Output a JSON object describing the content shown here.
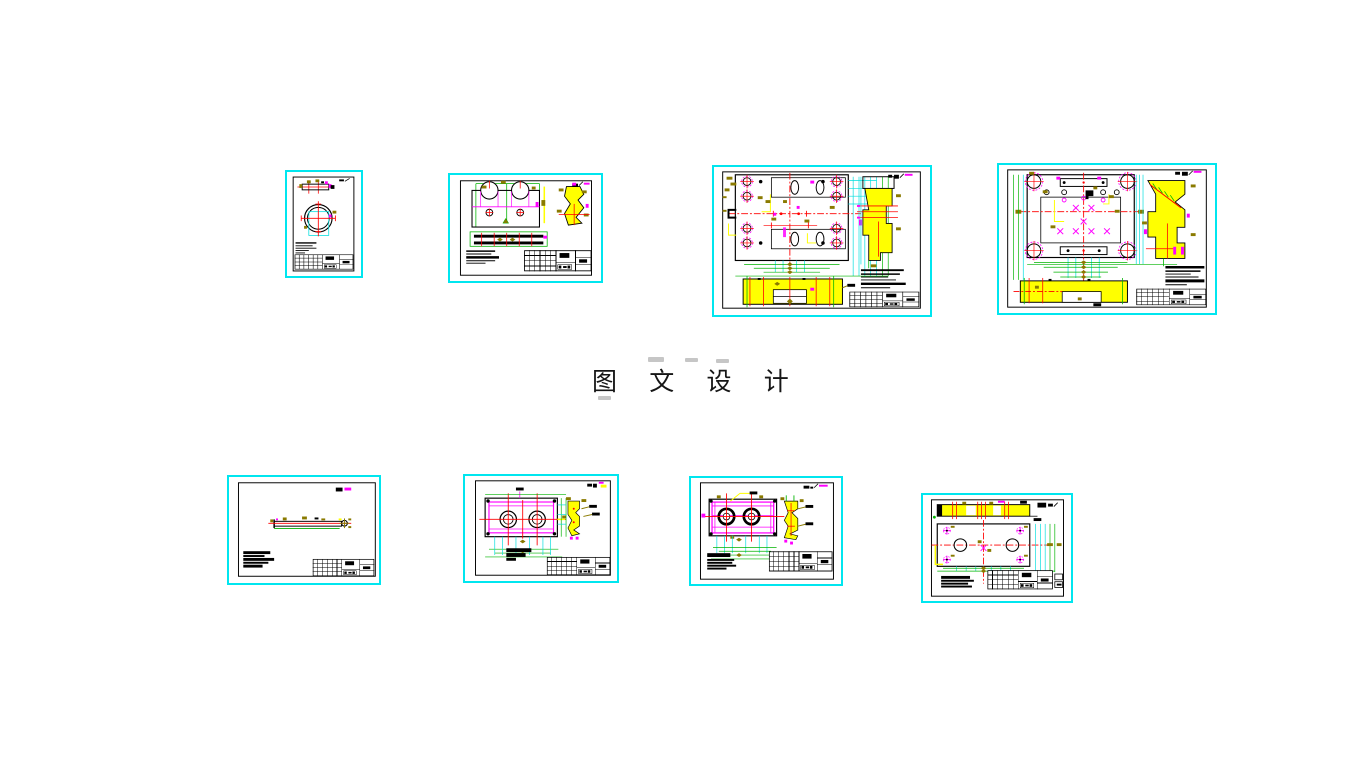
{
  "page": {
    "title": "图 文 设 计"
  },
  "palette": {
    "background": "#ffffff",
    "sheet_frame_cyan": "#00e6ef",
    "line_black": "#000000",
    "centerline_red": "#ff0000",
    "section_fill_yellow": "#ffff00",
    "detail_magenta": "#ff00ff",
    "dimension_green": "#00b400",
    "dimension_cyan": "#00dede",
    "hardware_olive": "#8a7a00",
    "smudge_gray": "#c6c6c6"
  },
  "sheets": [
    {
      "id": "sheet-1",
      "name": "ring-part-drawing",
      "orientation": "portrait"
    },
    {
      "id": "sheet-2",
      "name": "clamp-block-drawing",
      "orientation": "landscape"
    },
    {
      "id": "sheet-3",
      "name": "mold-plate-assembly-drawing",
      "orientation": "landscape"
    },
    {
      "id": "sheet-4",
      "name": "mold-plate-assembly-drawing-2",
      "orientation": "landscape"
    },
    {
      "id": "sheet-5",
      "name": "shaft-part-drawing",
      "orientation": "landscape"
    },
    {
      "id": "sheet-6",
      "name": "twin-bore-plate-drawing",
      "orientation": "landscape"
    },
    {
      "id": "sheet-7",
      "name": "twin-bore-plate-drawing-2",
      "orientation": "landscape"
    },
    {
      "id": "sheet-8",
      "name": "guide-plate-drawing",
      "orientation": "landscape"
    }
  ]
}
